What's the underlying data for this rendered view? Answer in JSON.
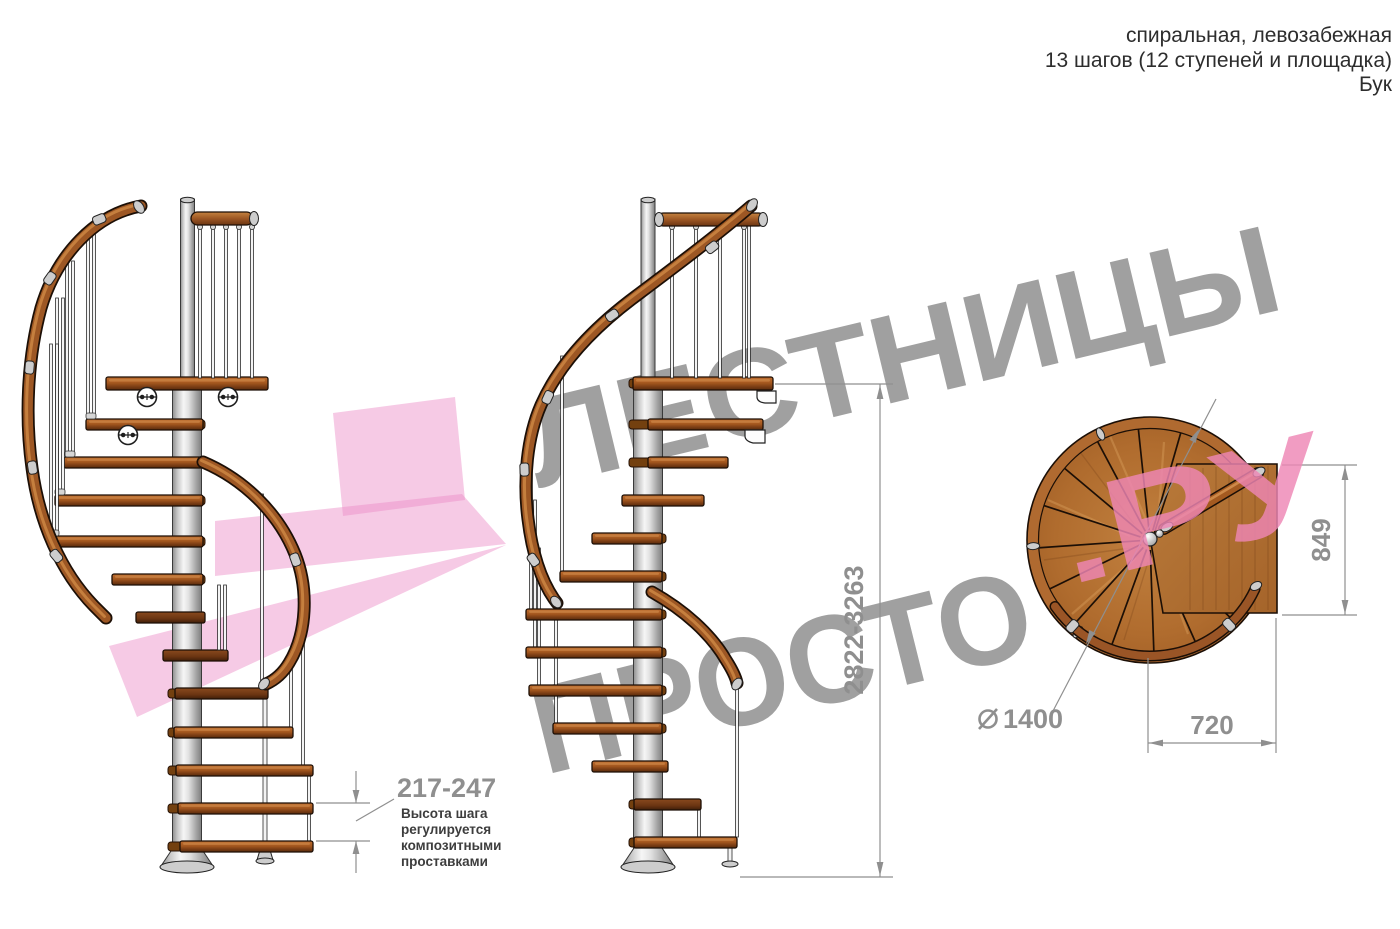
{
  "header": {
    "line1": "спиральная, левозабежная",
    "line2": "13 шагов (12 ступеней и площадка)",
    "line3": "Бук"
  },
  "watermark": {
    "brand_line1": "ЛЕСТНИЦЫ",
    "brand_line2_gray": "ПРОСТО",
    "brand_line2_pink": ".РУ",
    "gray_color": "#9b9b9b",
    "pink_color": "#ee86b4",
    "logo_pink_color": "#ec89c6"
  },
  "dimensions": {
    "total_height": "2822-3263",
    "step_height": "217-247",
    "landing_depth": "849",
    "landing_width": "720",
    "diameter_symbol": "⌀",
    "diameter_value": "1400",
    "note_line1": "Высота шага",
    "note_line2": "регулируется",
    "note_line3": "композитными",
    "note_line4": "проставками"
  },
  "colors": {
    "wood_step": "#a5581f",
    "wood_rail": "#9d5724",
    "plan_wood": "#b06c2e",
    "metal_pole": "#d9d9d9",
    "dimension_gray": "#8f8f8f",
    "note_text": "#3d3d3d",
    "header_text": "#2d2d2d"
  }
}
